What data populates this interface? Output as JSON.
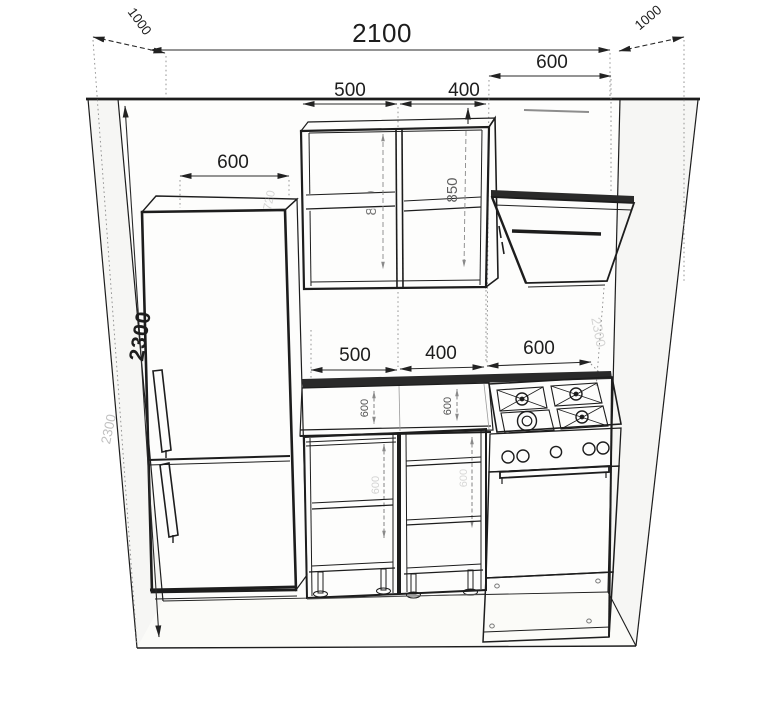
{
  "drawing": {
    "kind": "kitchen-elevation-perspective",
    "colors": {
      "line": "#1d1d1d",
      "dim_text": "#1d1d1d",
      "faint": "#8f8f8f",
      "background": "#ffffff"
    },
    "dims": {
      "room_width": "2100",
      "side_depth_left": "1000",
      "side_depth_right": "1000",
      "hood_width": "600",
      "fridge_width": "600",
      "wall_height": "2300",
      "wall_height_ghost_left": "2300",
      "wall_height_ghost_right": "2300",
      "upper_cab_left_width": "500",
      "upper_cab_right_width": "400",
      "upper_cab_left_height": "850",
      "upper_cab_right_height": "850",
      "fridge_depth_ghost": "720",
      "base_left_width": "500",
      "base_mid_width": "400",
      "stove_width": "600",
      "counter_depth_a": "600",
      "counter_depth_b": "600",
      "base_inner_a": "600",
      "base_inner_b": "600"
    }
  }
}
